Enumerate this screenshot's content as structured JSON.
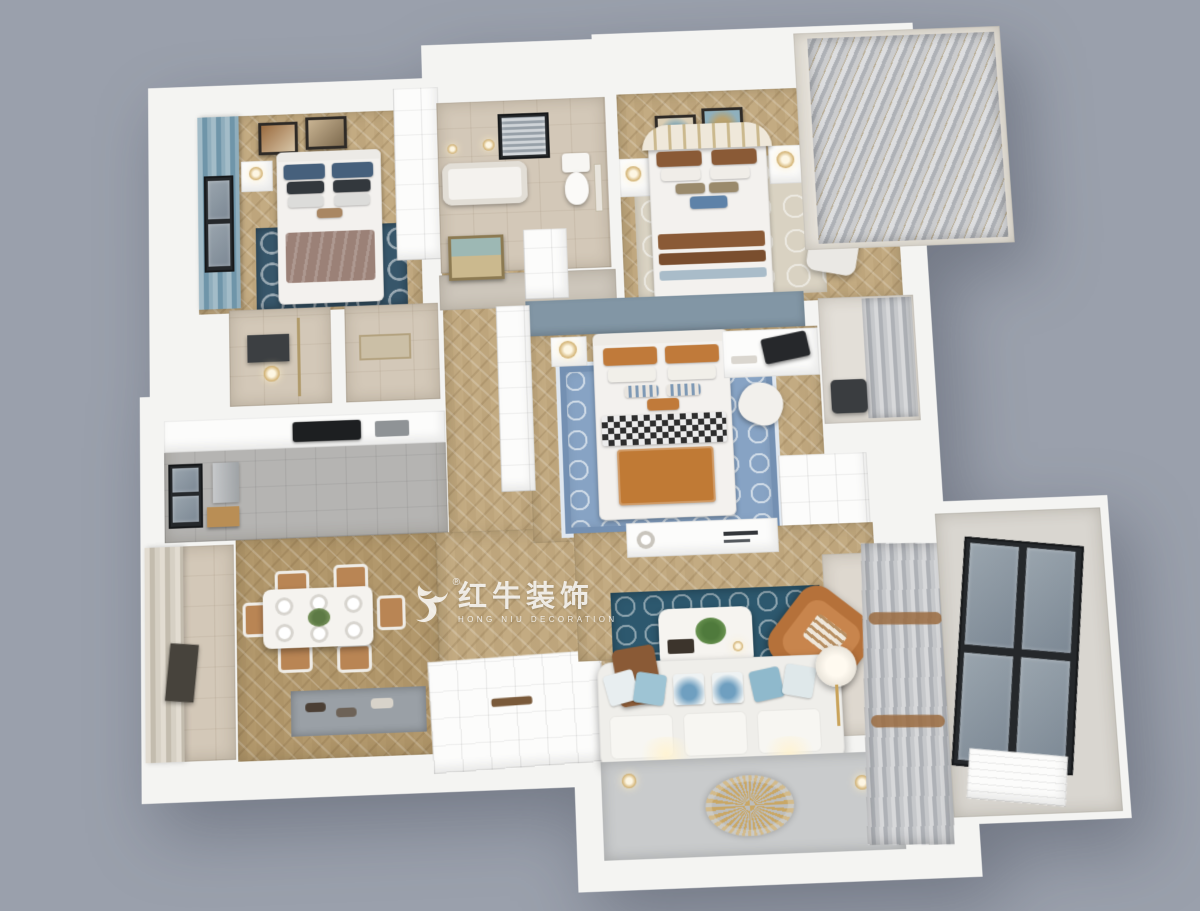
{
  "watermark": {
    "logo": "bull-icon",
    "registered": "®",
    "brand_cn": "红牛装饰",
    "brand_en": "HONG NIU DECORATION"
  },
  "palette": {
    "background": "#9aa0ac",
    "slab": "#f4f4f2",
    "wood": "#c3ab82",
    "wood_dark": "#b2986c",
    "beige_tile": "#d3c8b8",
    "kitchen_floor": "#b5b4b2",
    "rug_navy": "#37566a",
    "rug_teal": "#2d586e",
    "rug_blue": "#87a3c4",
    "leather": "#b5713a",
    "accent_wall": "#8296a5",
    "tv_wall": "#c9cbcc",
    "gold": "#c9a35a",
    "curtain_teal": "#7ca2b4",
    "curtain_gray": "#bfc2c6",
    "blanket_mauve": "#9b8177",
    "pillow_navy": "#46607c",
    "pillow_brown": "#8a5a36",
    "pillow_orange": "#c07a3a"
  }
}
